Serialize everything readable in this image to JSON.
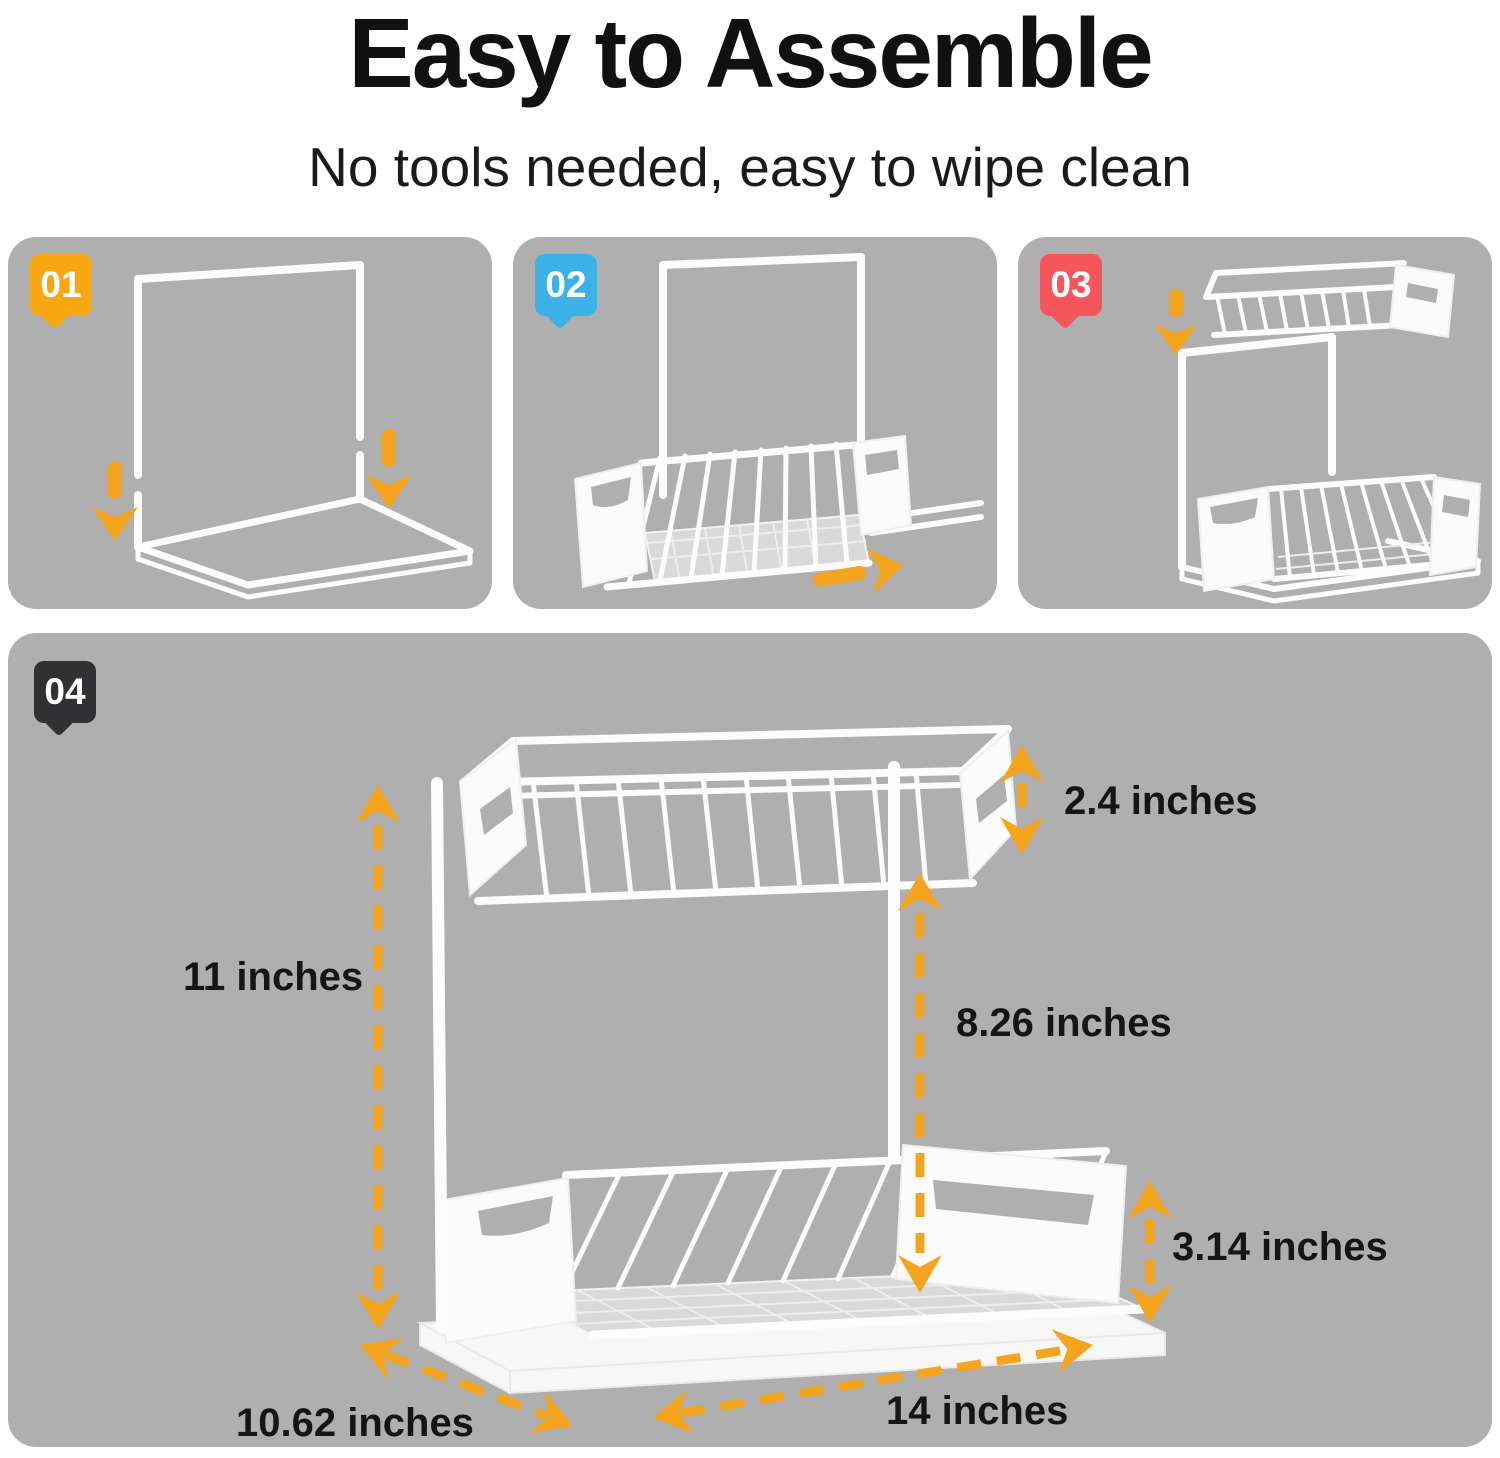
{
  "header": {
    "title": "Easy to Assemble",
    "subtitle": "No tools needed, easy to wipe clean"
  },
  "steps": [
    {
      "number": "01",
      "badge_color": "#F7A712"
    },
    {
      "number": "02",
      "badge_color": "#3DB2E6"
    },
    {
      "number": "03",
      "badge_color": "#F4565C"
    },
    {
      "number": "04",
      "badge_color": "#323234"
    }
  ],
  "dimensions": {
    "overall_height": "11 inches",
    "top_basket_height": "2.4 inches",
    "middle_clearance": "8.26 inches",
    "bottom_basket_height": "3.14 inches",
    "depth": "10.62 inches",
    "width": "14 inches"
  },
  "colors": {
    "arrow_orange": "#F5A41D",
    "panel_gray": "#AFAFAF"
  }
}
